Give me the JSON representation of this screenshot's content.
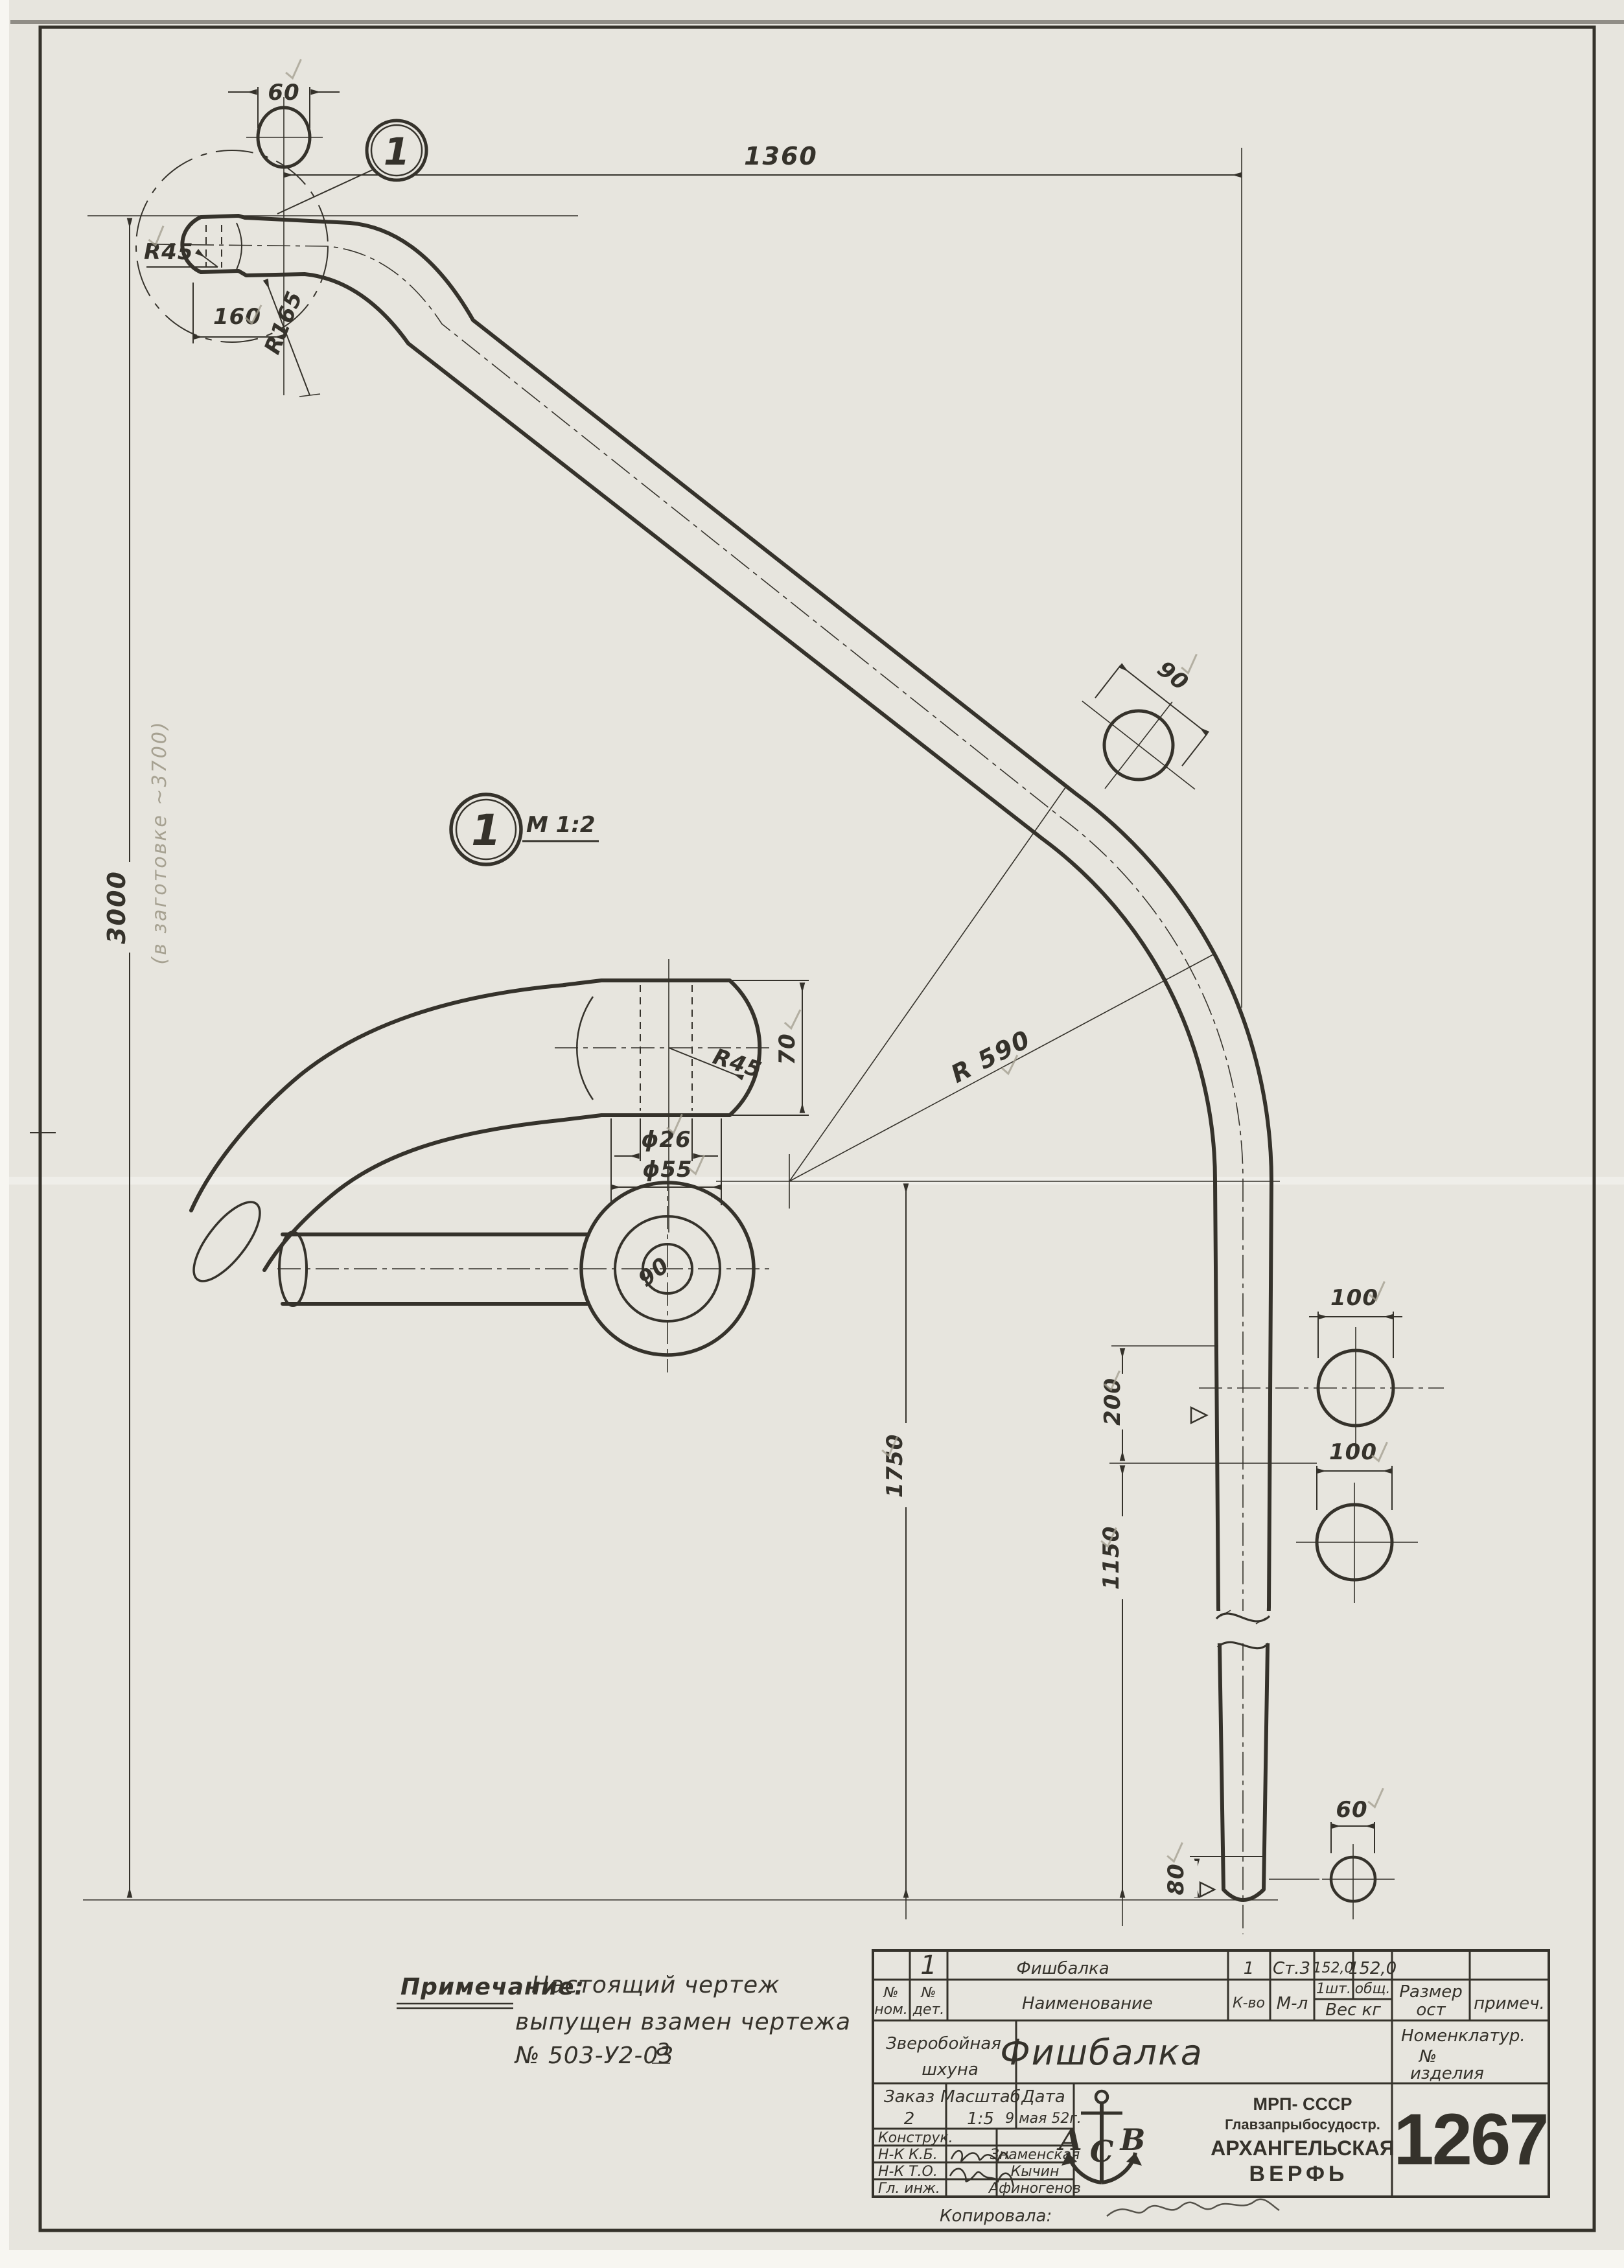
{
  "balloons": {
    "detail_number": "1",
    "scale_note": "М 1:2"
  },
  "dims": {
    "top_section_width": "60",
    "fitting_length": "160",
    "fitting_radius": "R45",
    "bend_radius": "R165",
    "horizontal_span": "1360",
    "vertical_span": "3000",
    "slope_section": "90",
    "main_bend_radius": "R 590",
    "detail_height": "70",
    "detail_ball_radius": "R45",
    "hole_diameter": "ϕ26",
    "neck_diameter": "ϕ55",
    "eye_width": "90",
    "upper_shaft_section": "100",
    "lower_shaft_section": "100",
    "weld_zone": "200",
    "lower_span": "1150",
    "overall_drop": "1750",
    "tip_section": "60",
    "tip_height": "80"
  },
  "pencil_note": "(в заготовке ~3700)",
  "note": {
    "label": "Примечание:",
    "line1": "Настоящий чертеж",
    "line2": "выпущен взамен чертежа",
    "line3": "№ 503-У2-03",
    "line3_sup": "а"
  },
  "title_block": {
    "headers": {
      "pos_no_1": "№",
      "pos_no_2": "ном.",
      "det_no_1": "№",
      "det_no_2": "дет.",
      "name": "Наименование",
      "qty": "К-во",
      "material": "М-л",
      "per_piece": "1шт.",
      "total": "общ.",
      "weight": "Вес кг",
      "size_std_1": "Размер",
      "size_std_2": "ост",
      "remark": "примеч."
    },
    "part": {
      "det_no": "1",
      "name": "Фишбалка",
      "qty": "1",
      "material": "Ст.3",
      "weight_each": "152,0",
      "weight_total": "152,0"
    },
    "project_line1": "Зверобойная",
    "project_line2": "шхуна",
    "title": "Фишбалка",
    "nomenclature_1": "Номенклатур.",
    "nomenclature_2": "№",
    "nomenclature_3": "изделия",
    "order_label": "Заказ",
    "order_value": "2",
    "scale_label": "Масштаб",
    "scale_value": "1:5",
    "date_label": "Дата",
    "date_value": "9 мая 52г.",
    "org_line1": "МРП- СССР",
    "org_line2": "Главзапрыбосудостр.",
    "org_line3": "АРХАНГЕЛЬСКАЯ",
    "org_line4": "ВЕРФЬ",
    "logo_a": "А",
    "logo_c": "С",
    "logo_b": "В",
    "drawing_number": "1267",
    "sig_rows": [
      {
        "label": "Конструк.",
        "name": ""
      },
      {
        "label": "Н-К К.Б.",
        "name": "Знаменская"
      },
      {
        "label": "Н-К Т.О.",
        "name": "Кычин"
      },
      {
        "label": "Гл. инж.",
        "name": "Афиногенов"
      }
    ],
    "copied_label": "Копировала:"
  }
}
